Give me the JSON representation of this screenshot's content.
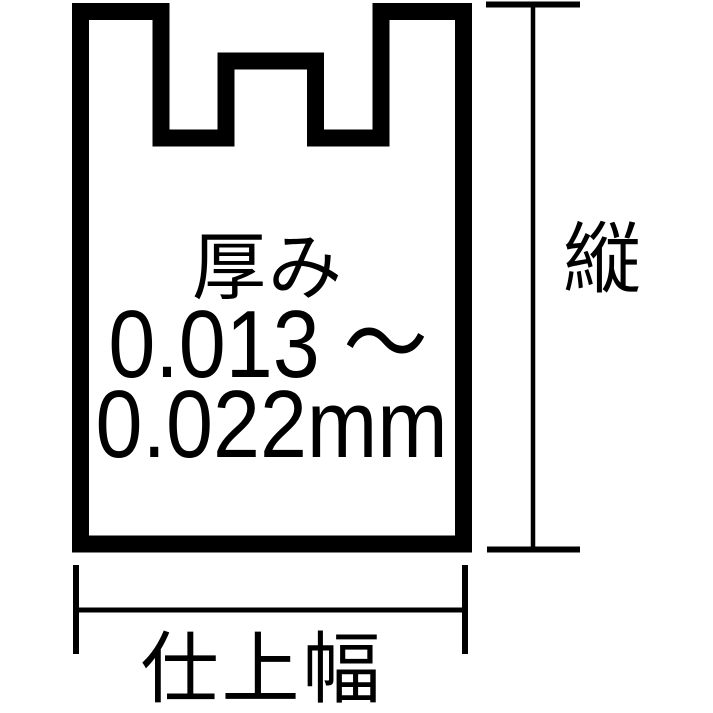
{
  "diagram": {
    "type": "bag-spec-diagram",
    "bag": {
      "thickness_label": "厚み",
      "thickness_value_from": "0.013 ～",
      "thickness_value_to": "0.022mm"
    },
    "dimensions": {
      "height_label": "縦",
      "width_label": "仕上幅"
    },
    "colors": {
      "ink": "#000000",
      "background": "#ffffff"
    }
  }
}
